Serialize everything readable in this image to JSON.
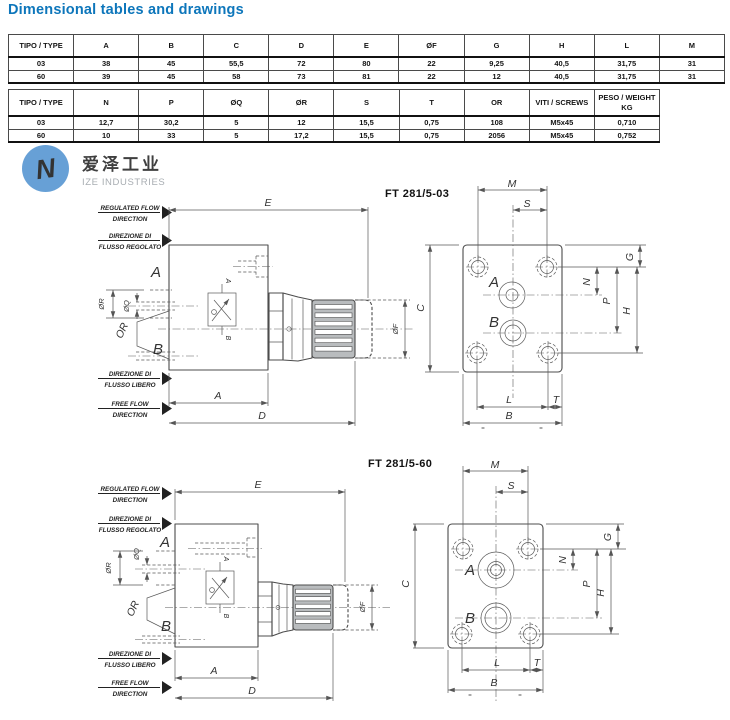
{
  "page": {
    "title": "Dimensional tables and drawings"
  },
  "logo": {
    "cn": "爱泽工业",
    "en": "IZE INDUSTRIES"
  },
  "table1": {
    "headers": [
      "TIPO / TYPE",
      "A",
      "B",
      "C",
      "D",
      "E",
      "ØF",
      "G",
      "H",
      "L",
      "M"
    ],
    "rows": [
      [
        "03",
        "38",
        "45",
        "55,5",
        "72",
        "80",
        "22",
        "9,25",
        "40,5",
        "31,75",
        "31"
      ],
      [
        "60",
        "39",
        "45",
        "58",
        "73",
        "81",
        "22",
        "12",
        "40,5",
        "31,75",
        "31"
      ]
    ]
  },
  "table2": {
    "headers": [
      "TIPO / TYPE",
      "N",
      "P",
      "ØQ",
      "ØR",
      "S",
      "T",
      "OR",
      "VITI / SCREWS",
      "PESO / WEIGHT\nKG"
    ],
    "rows": [
      [
        "03",
        "12,7",
        "30,2",
        "5",
        "12",
        "15,5",
        "0,75",
        "108",
        "M5x45",
        "0,710"
      ],
      [
        "60",
        "10",
        "33",
        "5",
        "17,2",
        "15,5",
        "0,75",
        "2056",
        "M5x45",
        "0,752"
      ]
    ]
  },
  "drawing1": {
    "title": "FT 281/5-03"
  },
  "drawing2": {
    "title": "FT 281/5-60"
  },
  "flow_labels": {
    "regulated_flow_l1": "REGULATED FLOW",
    "regulated_flow_l2": "DIRECTION",
    "direzione_regolato_l1": "DIREZIONE DI",
    "direzione_regolato_l2": "FLUSSO REGOLATO",
    "direzione_libero_l1": "DIREZIONE DI",
    "direzione_libero_l2": "FLUSSO LIBERO",
    "free_flow_l1": "FREE FLOW",
    "free_flow_l2": "DIRECTION"
  },
  "dims": {
    "e": "E",
    "a": "A",
    "d": "D",
    "phi_f": "ØF",
    "phi_q": "ØQ",
    "phi_r": "ØR",
    "or": "OR",
    "m": "M",
    "s": "S",
    "c": "C",
    "g": "G",
    "n": "N",
    "p": "P",
    "h": "H",
    "l": "L",
    "t": "T",
    "b": "B",
    "port_a": "A",
    "port_b": "B",
    "sym_a": "A",
    "sym_b": "B",
    "eq": "="
  }
}
